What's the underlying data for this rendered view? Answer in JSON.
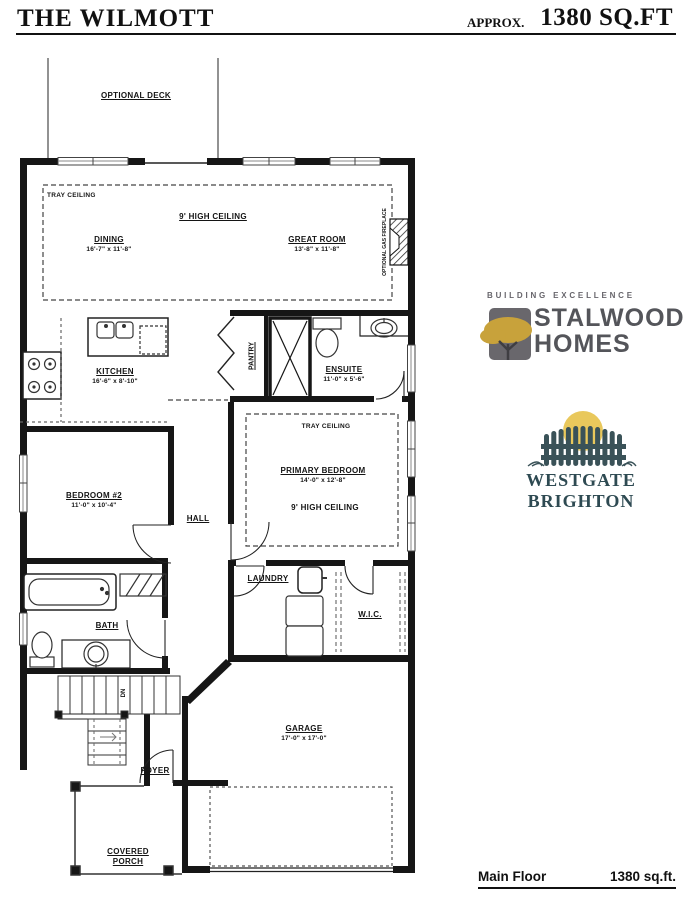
{
  "header": {
    "title": "THE WILMOTT",
    "approx": "APPROX.",
    "sqft": "1380 SQ.FT"
  },
  "plan": {
    "optional_deck": "OPTIONAL DECK",
    "tray_ceiling_great": "TRAY CEILING",
    "high_ceiling_great": "9' HIGH CEILING",
    "dining_name": "DINING",
    "dining_dims": "16'-7\" x 11'-8\"",
    "great_room_name": "GREAT ROOM",
    "great_room_dims": "13'-8\" x 11'-8\"",
    "fireplace": "OPTIONAL GAS FIREPLACE",
    "kitchen_name": "KITCHEN",
    "kitchen_dims": "16'-6\" x 8'-10\"",
    "pantry": "PANTRY",
    "ensuite_name": "ENSUITE",
    "ensuite_dims": "11'-0\" x 5'-6\"",
    "tray_ceiling_primary": "TRAY CEILING",
    "primary_name": "PRIMARY BEDROOM",
    "primary_dims": "14'-0\" x 12'-8\"",
    "high_ceiling_primary": "9' HIGH CEILING",
    "bedroom2_name": "BEDROOM #2",
    "bedroom2_dims": "11'-0\" x 10'-4\"",
    "hall": "HALL",
    "laundry": "LAUNDRY",
    "wic": "W.I.C.",
    "bath": "BATH",
    "dn": "DN",
    "foyer": "FOYER",
    "garage_name": "GARAGE",
    "garage_dims": "17'-0\" x 17'-0\"",
    "covered_porch_line1": "COVERED",
    "covered_porch_line2": "PORCH"
  },
  "branding": {
    "stalwood_tagline": "BUILDING EXCELLENCE",
    "stalwood_line1": "STALWOOD",
    "stalwood_line2": "HOMES",
    "westgate_name": "WESTGATE BRIGHTON"
  },
  "footer": {
    "label": "Main Floor",
    "value": "1380 sq.ft."
  },
  "colors": {
    "plan_line": "#161616",
    "stalwood_gray": "#67656b",
    "stalwood_gold": "#c8a23b",
    "westgate_slate": "#3a5258",
    "westgate_sun": "#e9c85c"
  }
}
